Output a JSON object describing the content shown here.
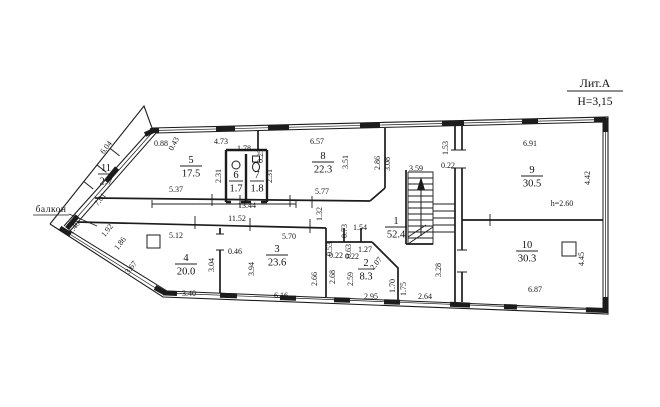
{
  "header": {
    "lit_label": "Лит.А",
    "height_label": "H=3,15"
  },
  "balcony": {
    "label": "балкон"
  },
  "rooms": [
    {
      "num": "1",
      "area": "52.4",
      "x": 396,
      "y": 224,
      "w": 22
    },
    {
      "num": "2",
      "area": "8.3",
      "x": 366,
      "y": 266,
      "w": 16
    },
    {
      "num": "3",
      "area": "23.6",
      "x": 277,
      "y": 252,
      "w": 22
    },
    {
      "num": "4",
      "area": "20.0",
      "x": 186,
      "y": 261,
      "w": 22
    },
    {
      "num": "5",
      "area": "17.5",
      "x": 191,
      "y": 163,
      "w": 22
    },
    {
      "num": "6",
      "area": "1.7",
      "x": 236,
      "y": 178,
      "w": 14
    },
    {
      "num": "7",
      "area": "1.8",
      "x": 257,
      "y": 178,
      "w": 14
    },
    {
      "num": "8",
      "area": "22.3",
      "x": 323,
      "y": 159,
      "w": 22
    },
    {
      "num": "9",
      "area": "30.5",
      "x": 532,
      "y": 173,
      "w": 22
    },
    {
      "num": "10",
      "area": "30.3",
      "x": 527,
      "y": 248,
      "w": 22
    },
    {
      "num": "11",
      "area": "2.7",
      "x": 106,
      "y": 171,
      "w": 16
    }
  ],
  "dimensions": [
    {
      "t": "0.88",
      "x": 161,
      "y": 146
    },
    {
      "t": "0.43",
      "x": 176,
      "y": 145,
      "r": -62
    },
    {
      "t": "4.73",
      "x": 221,
      "y": 144
    },
    {
      "t": "1.78",
      "x": 244,
      "y": 151
    },
    {
      "t": "0.25",
      "x": 263,
      "y": 156,
      "r": -90
    },
    {
      "t": "6.57",
      "x": 317,
      "y": 144
    },
    {
      "t": "3.51",
      "x": 348,
      "y": 162,
      "r": -90
    },
    {
      "t": "2.86",
      "x": 380,
      "y": 163,
      "r": -90
    },
    {
      "t": "3.08",
      "x": 390,
      "y": 164,
      "r": -90
    },
    {
      "t": "1.53",
      "x": 448,
      "y": 148,
      "r": -90
    },
    {
      "t": "0.22",
      "x": 448,
      "y": 168
    },
    {
      "t": "6.91",
      "x": 530,
      "y": 146
    },
    {
      "t": "4.42",
      "x": 590,
      "y": 178,
      "r": -90
    },
    {
      "t": "6.04",
      "x": 108,
      "y": 149,
      "r": -52
    },
    {
      "t": "7.01",
      "x": 102,
      "y": 201,
      "r": -52
    },
    {
      "t": "1.40",
      "x": 76,
      "y": 229,
      "r": -52
    },
    {
      "t": "1.92",
      "x": 109,
      "y": 232,
      "r": -52
    },
    {
      "t": "1.86",
      "x": 122,
      "y": 245,
      "r": -52
    },
    {
      "t": "3.67",
      "x": 133,
      "y": 269,
      "r": -52
    },
    {
      "t": "5.37",
      "x": 176,
      "y": 192
    },
    {
      "t": "13.44",
      "x": 247,
      "y": 208
    },
    {
      "t": "2.31",
      "x": 221,
      "y": 176,
      "r": -90
    },
    {
      "t": "2.31",
      "x": 272,
      "y": 176,
      "r": -90
    },
    {
      "t": "5.77",
      "x": 322,
      "y": 194
    },
    {
      "t": "1.32",
      "x": 322,
      "y": 214,
      "r": -90
    },
    {
      "t": "3.59",
      "x": 416,
      "y": 171
    },
    {
      "t": "11.52",
      "x": 237,
      "y": 221
    },
    {
      "t": "5.12",
      "x": 176,
      "y": 238
    },
    {
      "t": "0.46",
      "x": 235,
      "y": 254
    },
    {
      "t": "3.04",
      "x": 214,
      "y": 265,
      "r": -90
    },
    {
      "t": "3.94",
      "x": 254,
      "y": 269,
      "r": -90
    },
    {
      "t": "5.70",
      "x": 289,
      "y": 239
    },
    {
      "t": "2.66",
      "x": 317,
      "y": 279,
      "r": -90
    },
    {
      "t": "0.53",
      "x": 332,
      "y": 249,
      "r": -90
    },
    {
      "t": "0.22",
      "x": 336,
      "y": 258
    },
    {
      "t": "0.73",
      "x": 347,
      "y": 231,
      "r": -90
    },
    {
      "t": "1.54",
      "x": 360,
      "y": 230
    },
    {
      "t": "0.63",
      "x": 351,
      "y": 251,
      "r": -90
    },
    {
      "t": "1.27",
      "x": 365,
      "y": 252
    },
    {
      "t": "0.22",
      "x": 352,
      "y": 259
    },
    {
      "t": "2.68",
      "x": 335,
      "y": 277,
      "r": -90
    },
    {
      "t": "2.59",
      "x": 353,
      "y": 279,
      "r": -90
    },
    {
      "t": "2.07",
      "x": 378,
      "y": 265,
      "r": -50
    },
    {
      "t": "1.70",
      "x": 395,
      "y": 286,
      "r": -90
    },
    {
      "t": "1.75",
      "x": 406,
      "y": 289,
      "r": -90
    },
    {
      "t": "3.28",
      "x": 441,
      "y": 270,
      "r": -90
    },
    {
      "t": "3.40",
      "x": 189,
      "y": 296
    },
    {
      "t": "6.16",
      "x": 281,
      "y": 298
    },
    {
      "t": "2.95",
      "x": 371,
      "y": 299
    },
    {
      "t": "2.64",
      "x": 425,
      "y": 299
    },
    {
      "t": "6.87",
      "x": 535,
      "y": 292
    },
    {
      "t": "4.45",
      "x": 584,
      "y": 259,
      "r": -90
    },
    {
      "t": "h=2.60",
      "x": 562,
      "y": 206,
      "s": 9.5
    }
  ],
  "colors": {
    "line": "#1c1c1c",
    "text": "#161616",
    "background": "#ffffff"
  }
}
